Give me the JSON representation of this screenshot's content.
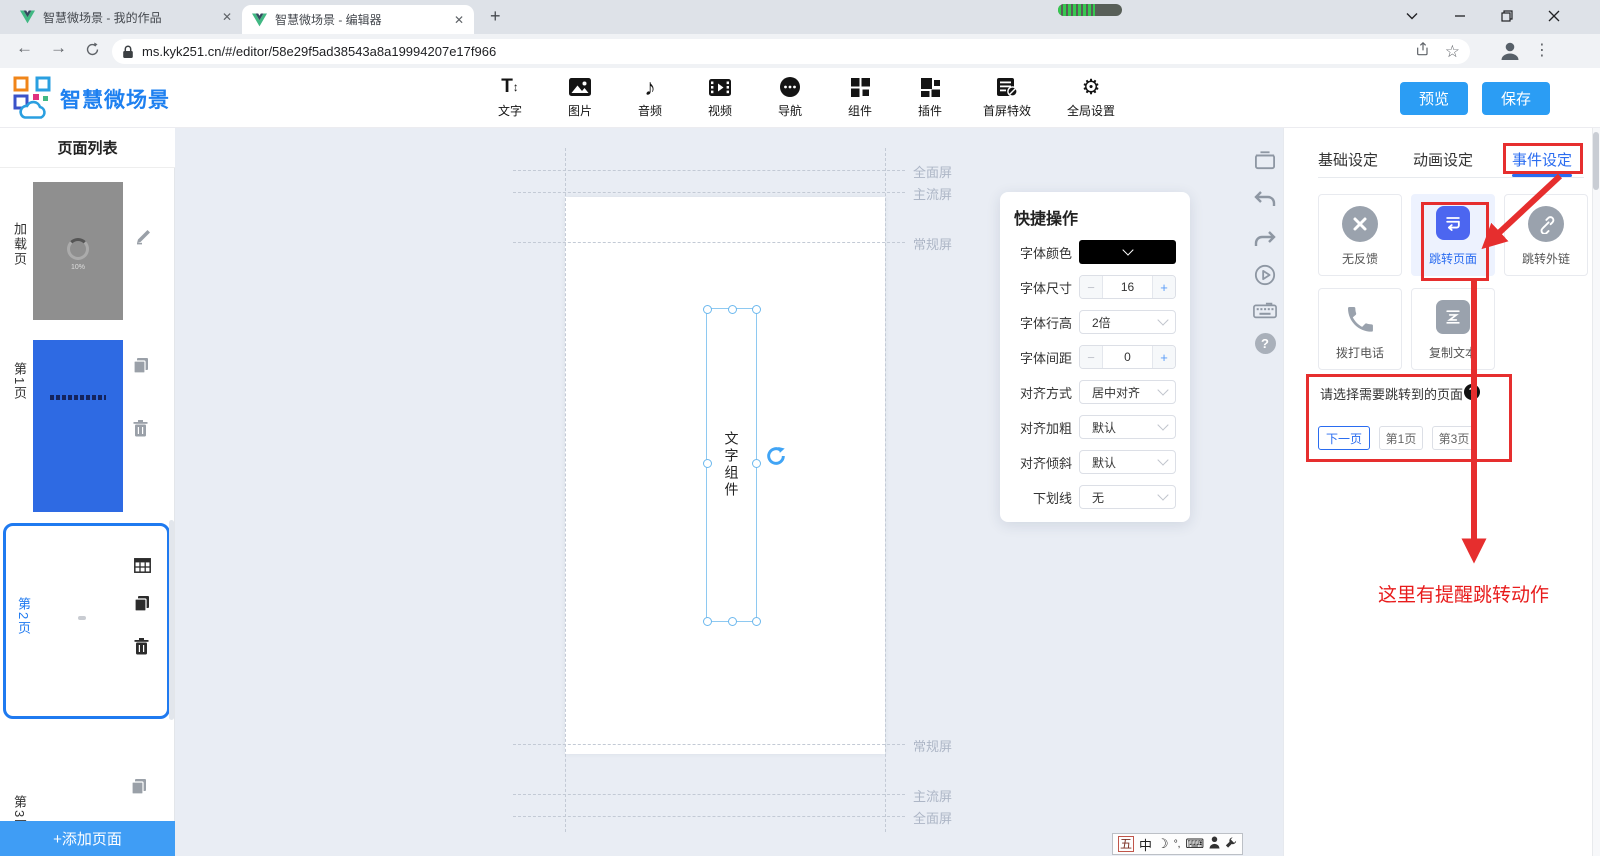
{
  "browser": {
    "tab1": "智慧微场景 - 我的作品",
    "tab2": "智慧微场景 - 编辑器",
    "url": "ms.kyk251.cn/#/editor/58e29f5ad38543a8a19994207e17f966"
  },
  "header": {
    "brand": "智慧微场景",
    "tools": [
      "文字",
      "图片",
      "音频",
      "视频",
      "导航",
      "组件",
      "插件",
      "首屏特效",
      "全局设置"
    ],
    "preview": "预览",
    "save": "保存"
  },
  "sidebar": {
    "title": "页面列表",
    "pages": [
      {
        "label": "加载页"
      },
      {
        "label": "第1页"
      },
      {
        "label": "第2页"
      },
      {
        "label": "第3页"
      }
    ],
    "loading": "10%",
    "add": "+添加页面"
  },
  "canvas": {
    "top_guides": [
      "全面屏",
      "主流屏",
      "常规屏"
    ],
    "bottom_guides": [
      "常规屏",
      "主流屏",
      "全面屏"
    ],
    "component": "文字组件"
  },
  "quick": {
    "title": "快捷操作",
    "rows": [
      {
        "label": "字体颜色",
        "value": ""
      },
      {
        "label": "字体尺寸",
        "value": "16"
      },
      {
        "label": "字体行高",
        "value": "2倍"
      },
      {
        "label": "字体间距",
        "value": "0"
      },
      {
        "label": "对齐方式",
        "value": "居中对齐"
      },
      {
        "label": "对齐加粗",
        "value": "默认"
      },
      {
        "label": "对齐倾斜",
        "value": "默认"
      },
      {
        "label": "下划线",
        "value": "无"
      }
    ]
  },
  "panel": {
    "tabs": [
      "基础设定",
      "动画设定",
      "事件设定"
    ],
    "active_tab": "事件设定",
    "events": [
      "无反馈",
      "跳转页面",
      "跳转外链",
      "拨打电话",
      "复制文本"
    ],
    "selected_event": "跳转页面",
    "prompt": "请选择需要跳转到的页面",
    "jumps": [
      "下一页",
      "第1页",
      "第3页"
    ],
    "selected_jump": "下一页",
    "note": "这里有提醒跳转动作"
  },
  "ime": {
    "k1": "五",
    "k2": "中",
    "moon": "☽",
    "punct": "°,",
    "kb": "⌨"
  },
  "icons": {
    "close": "✕",
    "plus": "+",
    "minus": "−",
    "back": "←",
    "forward": "→",
    "star": "☆",
    "kebab": "⋮",
    "help": "?",
    "note": "♪",
    "gear": "⚙",
    "text_tool": "T",
    "updown": "↕"
  },
  "colors": {
    "accent": "#2a6cf0",
    "annotation_red": "#e62e2e",
    "action_blue": "#2b9df4",
    "page_blue": "#2e6ae3"
  }
}
